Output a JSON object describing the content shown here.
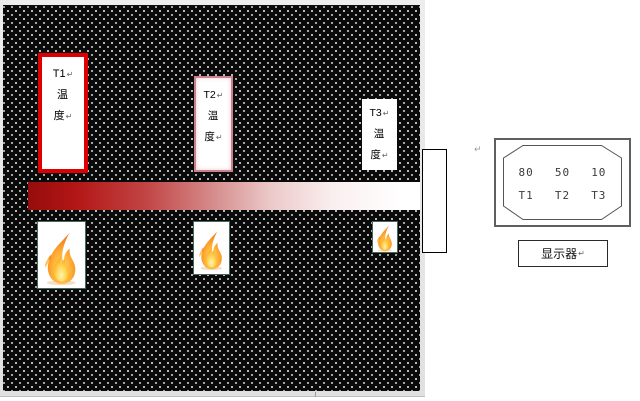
{
  "board": {
    "description_colors": {
      "background": "#0a0a0a",
      "dots": "#ffffff"
    }
  },
  "sensors": [
    {
      "name": "T1",
      "border_color": "#de0000",
      "lines": [
        {
          "t": "T1",
          "m": "↵"
        },
        {
          "t": "温",
          "m": ""
        },
        {
          "t": "度",
          "m": "↵"
        }
      ]
    },
    {
      "name": "T2",
      "border_color": "#c9818e",
      "lines": [
        {
          "t": "T2",
          "m": "↵"
        },
        {
          "t": "温",
          "m": ""
        },
        {
          "t": "度",
          "m": "↵"
        }
      ]
    },
    {
      "name": "T3",
      "border_color": "none",
      "lines": [
        {
          "t": "T3",
          "m": "↵"
        },
        {
          "t": "温",
          "m": ""
        },
        {
          "t": "度",
          "m": "↵"
        }
      ]
    }
  ],
  "rod": {
    "start_color": "#960c0c",
    "end_color": "#ffffff"
  },
  "flames": [
    {
      "size": "large"
    },
    {
      "size": "medium"
    },
    {
      "size": "small"
    }
  ],
  "display": {
    "values": [
      "80",
      "50",
      "10"
    ],
    "channels": [
      "T1",
      "T2",
      "T3"
    ],
    "caption": "显示器",
    "caption_mark": "↵"
  },
  "marks": {
    "wall_return": "↵"
  }
}
